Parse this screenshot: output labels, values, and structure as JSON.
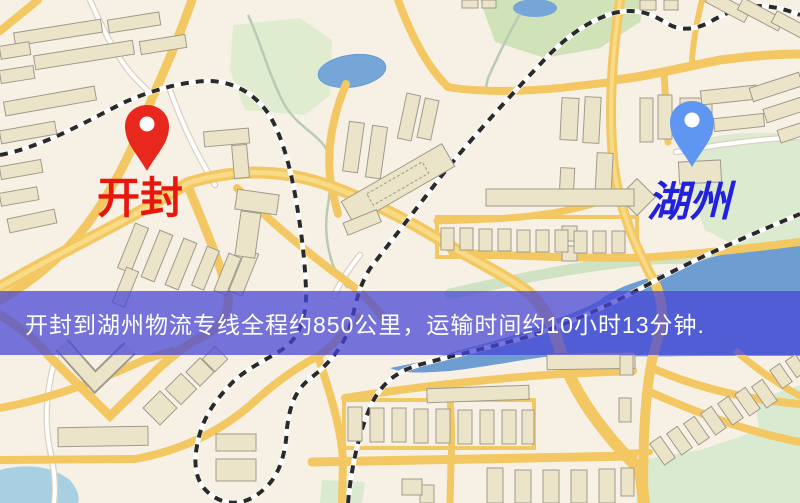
{
  "page": {
    "type": "map-route-preview"
  },
  "map": {
    "markers": [
      {
        "name": "开封",
        "pin_color": "#e8281c",
        "label_color": "#e8170e"
      },
      {
        "name": "湖州",
        "pin_color": "#5e96f2",
        "label_color": "#2222dd"
      }
    ],
    "banner": {
      "text": "开封到湖州物流专线全程约850公里，运输时间约10小时13分钟.",
      "background": "rgba(72,70,214,0.74)",
      "text_color": "#ffffff"
    },
    "route": {
      "origin": "开封",
      "destination": "湖州",
      "distance": "约850公里",
      "duration": "约10小时13分钟"
    }
  },
  "palette": {
    "map_background": "#f7f1e5",
    "road_yellow": "#f3c862",
    "water_blue": "#76a5d8",
    "park_green": "#d5e6bd",
    "building_beige": "#ece4c9",
    "railway_dark": "#2a2a2a"
  }
}
